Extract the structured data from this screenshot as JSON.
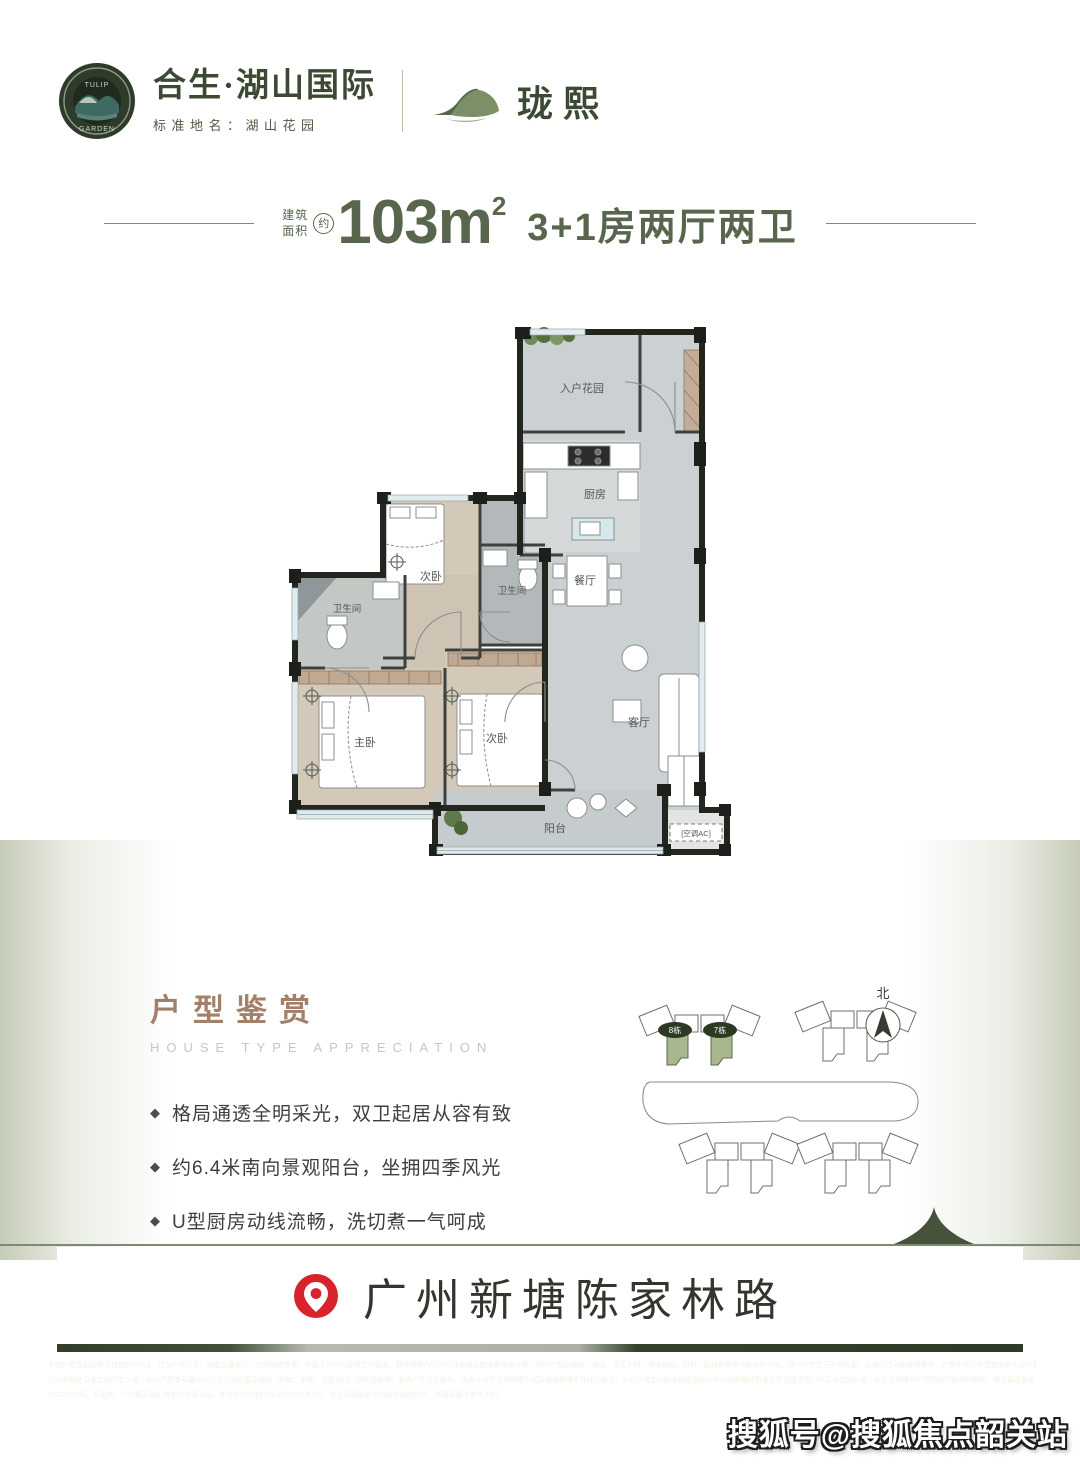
{
  "header": {
    "emblem_line1": "TULIP",
    "emblem_line2": "GARDEN",
    "brand_name": "合生·湖山国际",
    "standard_name": "标准地名：湖山花园",
    "sub_brand": "珑熙"
  },
  "title": {
    "prefix1": "建筑",
    "prefix2": "面积",
    "approx": "约",
    "area_value": "103m",
    "area_sup": "2",
    "layout_spec": "3+1房两厅两卫"
  },
  "floorplan": {
    "entry_garden": "入户花园",
    "kitchen": "厨房",
    "bedroom_top": "次卧",
    "bath_center": "卫生间",
    "dining": "餐厅",
    "bath_left": "卫生间",
    "master": "主卧",
    "bedroom_bottom": "次卧",
    "living": "客厅",
    "balcony": "阳台",
    "ac": "[空调AC]"
  },
  "appreciation": {
    "title": "户型鉴赏",
    "subtitle": "HOUSE TYPE APPRECIATION",
    "bullet_icon": "◆",
    "bullets": [
      "格局通透全明采光，双卫起居从容有致",
      "约6.4米南向景观阳台，坐拥四季风光",
      "U型厨房动线流畅，洗切煮一气呵成",
      "LDK客餐厨一体设计，突破空间界限 延伸幸福生活尺度"
    ],
    "siteplan": {
      "north": "北",
      "building8": "8栋",
      "building7": "7栋"
    }
  },
  "location": {
    "address": "广州新塘陈家林路"
  },
  "footer": {
    "line1": "本图户型信息面积为建筑约103㎡，仅为户型示意、功能位置展示，仅供购房参考，不属于交付内容和交付标准，装饰墙室内空间尺寸按规划图纸集中统计算，相同户型因楼栋、楼层、单元不同，墙体结构、面积、管线布置等可能有所不同，同一户型位于不同位置，具体尺寸可能有所差异，户型中所示的建筑面积为设计数据，标示尺寸仅供参考，具体的面积、尺寸等以政府最终批准之法律文件及双方签",
    "line2": "订的商品房买卖合同约定为准。部分户型单元展示的公共区域位置及结构（例如：电梯、消防出口、消防管道等）非该户型业主独有，出卖人对于空间使用方式及使用期限不作任何承诺，公共区域交付标准按规划设计并以政府最终批准文件及双方签订的买卖合同为准。本公司保留对户型图进行修改的权利，敬请留意最新资料。本项目政府备案的推广名为合生湖山花园，预售证号：穗建设预（增）字第",
    "line3": "20220326号。开发商：广州聚天湖山房地产有限公司。本宣传材料制作时间为2023年5月。本公司保留对该材料修改的权利，请谨慎置业参考资料。"
  },
  "watermark": {
    "text": "搜狐号@搜狐焦点韶关站"
  }
}
